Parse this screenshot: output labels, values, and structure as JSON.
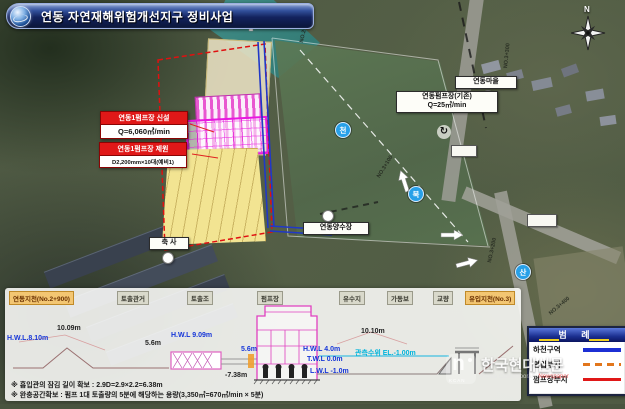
{
  "title": "연동 자연재해위험개선지구 정비사업",
  "map": {
    "direction_label": "금강방향",
    "compass_n": "N",
    "village_label": "연동마을",
    "existing_pump_line1": "연동펌프장(기존)",
    "existing_pump_line2": "Q=25㎥/min",
    "new_pump_header": "연동1펌프장 신설",
    "new_pump_body": "Q=6,060㎥/min",
    "pump_spec_header": "연동1펌프장 제원",
    "pump_spec_body": "D2,200mm×10대(예비1)",
    "intake_label": "연동양수장",
    "barn_label": "축 사",
    "badge_stream": "천",
    "badge_buk": "북",
    "badge_san": "산",
    "rotate_symbol": "↻",
    "stations": [
      "NO.2+900",
      "NO.3+100",
      "NO.3+200",
      "NO.3+300",
      "NO.3+400"
    ]
  },
  "section": {
    "chips": [
      "연동지천(No.2+900)",
      "토출관거",
      "토출조",
      "펌프장",
      "유수지",
      "가동보",
      "교량",
      "유입지천(No.3)"
    ],
    "labels": {
      "hwl_left": "H.W.L.8.10m",
      "levee": "10.09m",
      "span1": "5.6m",
      "hwl_tank": "H.W.L 9.09m",
      "span2": "5.6m",
      "depth": "-7.38m",
      "span3": "10.10m",
      "hwl_right": "H.W.L 4.0m",
      "twl_right": "T.W.L 0.0m",
      "lwl_right": "L.W.L -1.0m",
      "obs": "관측수위 EL.-1.00m"
    },
    "notes": [
      "※ 흡입관의 잠김 길이 확보 : 2.9D=2.9×2.2=6.38m",
      "※ 완충공간확보 : 펌프 1대 토출량의 5분에 해당하는 용량(3,350㎥=670㎥/min × 5분)"
    ]
  },
  "legend": {
    "title": "범  례",
    "items": [
      {
        "label": "하천구역",
        "color": "#1c2fd4",
        "style": "solid"
      },
      {
        "label": "편입부지",
        "color": "#e2761c",
        "style": "dashed"
      },
      {
        "label": "펌프장부지",
        "color": "#e01818",
        "style": "solid"
      }
    ]
  },
  "watermark": {
    "name": "한국현대신문",
    "subtitle_a": "Korea Contemporary ",
    "subtitle_b": "Newspaper",
    "mark": "KCAN"
  },
  "colors": {
    "title_bar": "#13235e",
    "site_outline_red": "#e01010",
    "culvert_blue": "#2038c8",
    "structure_magenta": "#e040c0",
    "water_cyan": "#40c0e0",
    "river_teal": "#3a8a88"
  }
}
